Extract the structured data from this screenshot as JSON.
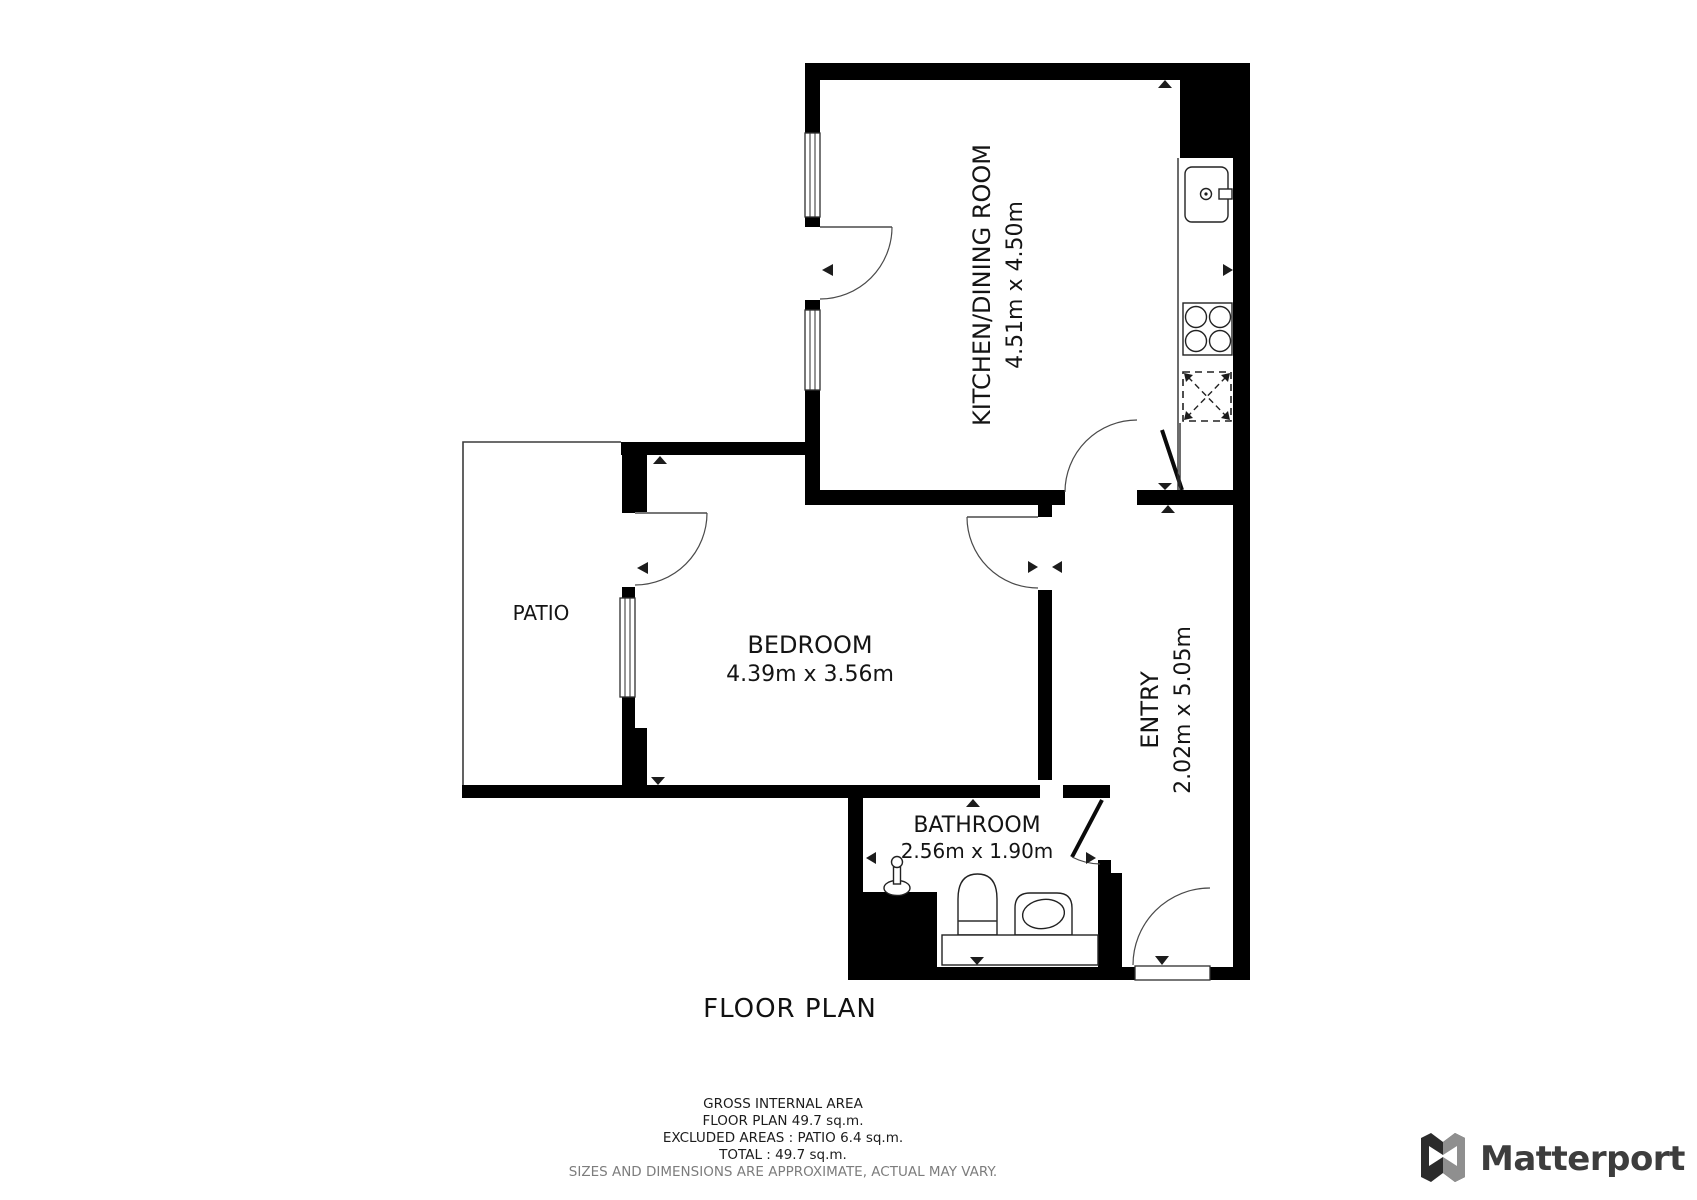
{
  "floor_plan": {
    "title": "FLOOR PLAN",
    "rooms": {
      "kitchen": {
        "name": "KITCHEN/DINING ROOM",
        "dims": "4.51m x 4.50m"
      },
      "bedroom": {
        "name": "BEDROOM",
        "dims": "4.39m x 3.56m"
      },
      "patio": {
        "name": "PATIO"
      },
      "entry": {
        "name": "ENTRY",
        "dims": "2.02m x 5.05m"
      },
      "bathroom": {
        "name": "BATHROOM",
        "dims": "2.56m x 1.90m"
      }
    }
  },
  "area_summary": {
    "heading": "GROSS INTERNAL AREA",
    "floor_plan_line": "FLOOR PLAN 49.7 sq.m.",
    "excluded_line": "EXCLUDED AREAS :  PATIO 6.4 sq.m.",
    "total_line": "TOTAL :  49.7 sq.m.",
    "disclaimer": "SIZES AND DIMENSIONS ARE APPROXIMATE, ACTUAL MAY VARY."
  },
  "branding": {
    "name": "Matterport"
  },
  "colors": {
    "wall": "#000000",
    "line": "#2e2e2e",
    "disclaimer": "#7d7d7d",
    "logo_text": "#3d3d3d"
  }
}
